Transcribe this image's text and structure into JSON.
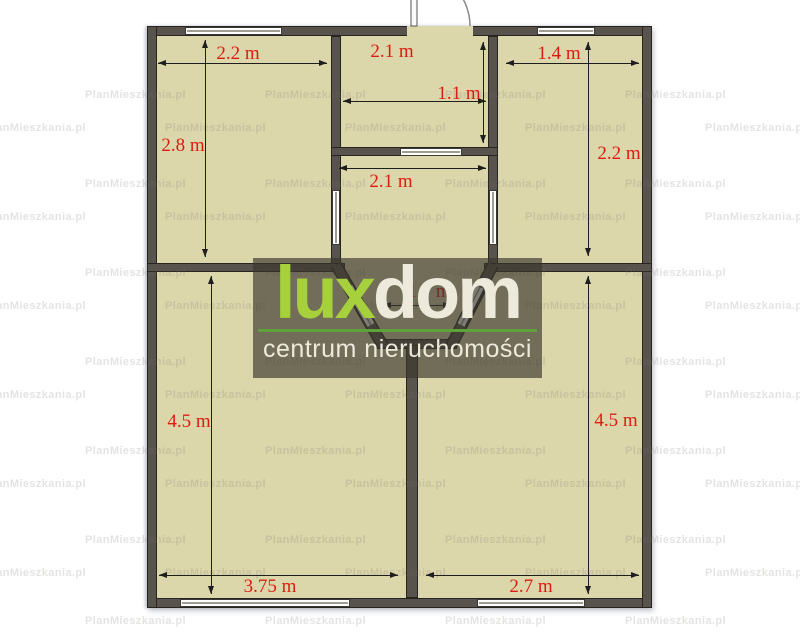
{
  "colors": {
    "floor": "#dcd6ab",
    "wall": "#59534d",
    "dimension_text": "#dd1c11",
    "watermark_text": "rgba(120,117,110,0.20)",
    "logo_overlay_bg": "rgba(58,54,45,0.66)"
  },
  "watermark": {
    "text": "PlanMieszkania.pl",
    "rows": [
      {
        "y": 96,
        "x_start": 85,
        "x_step": 180
      },
      {
        "y": 129,
        "x_start": -15,
        "x_step": 180
      },
      {
        "y": 185,
        "x_start": 85,
        "x_step": 180
      },
      {
        "y": 218,
        "x_start": -15,
        "x_step": 180
      },
      {
        "y": 274,
        "x_start": 85,
        "x_step": 180
      },
      {
        "y": 307,
        "x_start": -15,
        "x_step": 180
      },
      {
        "y": 363,
        "x_start": 85,
        "x_step": 180
      },
      {
        "y": 396,
        "x_start": -15,
        "x_step": 180
      },
      {
        "y": 452,
        "x_start": 85,
        "x_step": 180
      },
      {
        "y": 485,
        "x_start": -15,
        "x_step": 180
      },
      {
        "y": 541,
        "x_start": 85,
        "x_step": 180
      },
      {
        "y": 574,
        "x_start": -15,
        "x_step": 180
      },
      {
        "y": 622,
        "x_start": 85,
        "x_step": 180
      }
    ]
  },
  "logo": {
    "brand_green_part": "lux",
    "brand_light_part": "dom",
    "subtitle": "centrum nieruchomości",
    "green": "#a6d13c",
    "cream": "#edeadc",
    "underline_green": "#5ea23c"
  },
  "plan": {
    "unit": "m",
    "dimensions": [
      {
        "id": "top-left-room-width",
        "text": "2.2 m",
        "orientation": "h",
        "x1": 158,
        "x2": 327,
        "y": 63,
        "lx": 238,
        "ly": 54,
        "under_overlay": false
      },
      {
        "id": "top-left-room-height",
        "text": "2.8 m",
        "orientation": "v",
        "y1": 40,
        "y2": 257,
        "x": 205,
        "lx": 183,
        "ly": 146,
        "under_overlay": false
      },
      {
        "id": "hall-width",
        "text": "2.1 m",
        "orientation": "h",
        "x1": 343,
        "x2": 486,
        "y": 101,
        "lx": 392,
        "ly": 52,
        "under_overlay": false
      },
      {
        "id": "hall-height",
        "text": "1.1 m",
        "orientation": "v",
        "y1": 42,
        "y2": 143,
        "x": 483,
        "lx": 459,
        "ly": 94,
        "under_overlay": false
      },
      {
        "id": "top-right-room-width",
        "text": "1.4 m",
        "orientation": "h",
        "x1": 506,
        "x2": 639,
        "y": 63,
        "lx": 559,
        "ly": 54,
        "under_overlay": false
      },
      {
        "id": "top-right-room-height",
        "text": "2.2 m",
        "orientation": "v",
        "y1": 42,
        "y2": 256,
        "x": 588,
        "lx": 619,
        "ly": 154,
        "under_overlay": false
      },
      {
        "id": "bay-room-width",
        "text": "2.1 m",
        "orientation": "h",
        "x1": 339,
        "x2": 486,
        "y": 168,
        "lx": 391,
        "ly": 182,
        "under_overlay": false
      },
      {
        "id": "bay-bottom-width",
        "text": "1.7 m",
        "orientation": "h",
        "x1": 383,
        "x2": 451,
        "y": 305,
        "lx": 429,
        "ly": 292,
        "under_overlay": true
      },
      {
        "id": "bottom-left-room-height",
        "text": "4.5 m",
        "orientation": "v",
        "y1": 276,
        "y2": 594,
        "x": 211,
        "lx": 189,
        "ly": 422,
        "under_overlay": false
      },
      {
        "id": "bottom-left-room-width",
        "text": "3.75 m",
        "orientation": "h",
        "x1": 159,
        "x2": 398,
        "y": 575,
        "lx": 270,
        "ly": 587,
        "under_overlay": false
      },
      {
        "id": "bottom-right-room-height",
        "text": "4.5 m",
        "orientation": "v",
        "y1": 276,
        "y2": 594,
        "x": 588,
        "lx": 616,
        "ly": 421,
        "under_overlay": false
      },
      {
        "id": "bottom-right-room-width",
        "text": "2.7 m",
        "orientation": "h",
        "x1": 426,
        "x2": 639,
        "y": 575,
        "lx": 531,
        "ly": 587,
        "under_overlay": false
      }
    ]
  }
}
